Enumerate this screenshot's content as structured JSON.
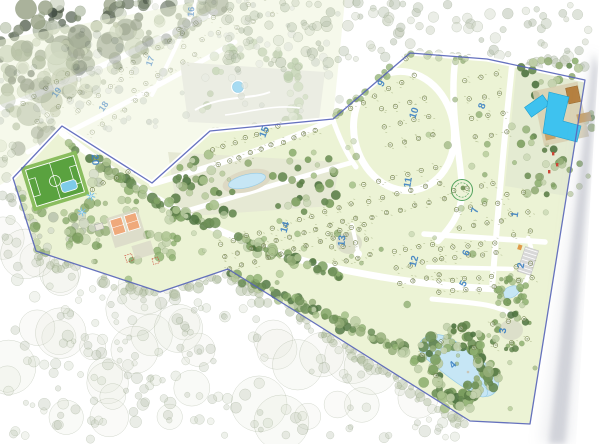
{
  "map": {
    "title_hidden": "",
    "colors": {
      "land": "#ecf3d5",
      "faded_land": "#eef4d8",
      "road": "#ffffff",
      "boundary": "#5563b8",
      "zone_label": "#3a7ec2",
      "marker": "#66753b",
      "marker_text": "#44541f",
      "water": "#c6e6f5",
      "water_edge": "#97cbe4",
      "pool": "#3ec2ef",
      "field_green": "#5aa23f",
      "field_band": "#8abd5e",
      "court_orange": "#efa97b",
      "clearing": "#dcdfca",
      "resort_ground": "#e4ebd2",
      "deck_tan": "#d8cfb0",
      "building_brown": "#b5803f",
      "building_tan": "#c9a268",
      "accent_red": "#cc4737",
      "palm_blue": "#7fc3e8",
      "roundabout_green": "#52a25c",
      "page_shadow": "#aab0ba"
    },
    "boundary_points": [
      [
        13,
        178
      ],
      [
        62,
        126
      ],
      [
        152,
        183
      ],
      [
        210,
        131
      ],
      [
        333,
        119
      ],
      [
        410,
        53
      ],
      [
        487,
        59
      ],
      [
        585,
        80
      ],
      [
        530,
        424
      ],
      [
        470,
        421
      ],
      [
        300,
        314
      ],
      [
        228,
        269
      ],
      [
        160,
        292
      ],
      [
        36,
        251
      ]
    ],
    "faded_land_points": [
      [
        0,
        40
      ],
      [
        205,
        0
      ],
      [
        345,
        0
      ],
      [
        333,
        119
      ],
      [
        210,
        131
      ],
      [
        152,
        183
      ],
      [
        62,
        126
      ],
      [
        13,
        178
      ],
      [
        0,
        185
      ]
    ],
    "park_faded": {
      "clearing": [
        [
          180,
          62
        ],
        [
          325,
          72
        ],
        [
          318,
          128
        ],
        [
          188,
          122
        ]
      ],
      "pool": {
        "cx": 238,
        "cy": 87,
        "r": 5.5
      }
    },
    "park_strip": [
      [
        168,
        152
      ],
      [
        340,
        162
      ],
      [
        332,
        206
      ],
      [
        178,
        217
      ]
    ],
    "zones": [
      {
        "number": "1",
        "label": {
          "x": 518,
          "y": 215,
          "rot": -80
        },
        "faded": false,
        "plots": {
          "cx": 519,
          "cy": 213,
          "w": 34,
          "h": 62,
          "rot": -10,
          "rows": 3,
          "cols": 2
        }
      },
      {
        "number": "2",
        "label": {
          "x": 524,
          "y": 266,
          "rot": -80
        },
        "faded": false,
        "plots": {
          "cx": 524,
          "cy": 272,
          "w": 28,
          "h": 30,
          "rot": -10,
          "rows": 2,
          "cols": 2
        }
      },
      {
        "number": "3",
        "label": {
          "x": 506,
          "y": 331,
          "rot": -85
        },
        "faded": false,
        "plots": {
          "cx": 510,
          "cy": 332,
          "w": 48,
          "h": 40,
          "rot": -10,
          "rows": 2,
          "cols": 3
        }
      },
      {
        "number": "4",
        "label": {
          "x": 455,
          "y": 367,
          "rot": -45
        },
        "faded": false,
        "plots": {
          "cx": 448,
          "cy": 352,
          "w": 70,
          "h": 50,
          "rot": -35,
          "rows": 2,
          "cols": 3
        }
      },
      {
        "number": "5",
        "label": {
          "x": 466,
          "y": 285,
          "rot": -62
        },
        "faded": false,
        "plots": {
          "cx": 466,
          "cy": 284,
          "w": 68,
          "h": 22,
          "rot": -5,
          "rows": 2,
          "cols": 5
        }
      },
      {
        "number": "6",
        "label": {
          "x": 469,
          "y": 254,
          "rot": -68
        },
        "faded": false,
        "plots": {
          "cx": 468,
          "cy": 251,
          "w": 68,
          "h": 20,
          "rot": -6,
          "rows": 2,
          "cols": 5
        }
      },
      {
        "number": "7",
        "label": {
          "x": 478,
          "y": 211,
          "rot": -78
        },
        "faded": false,
        "plots": {
          "cx": 477,
          "cy": 206,
          "w": 55,
          "h": 56,
          "rot": -10,
          "rows": 3,
          "cols": 4
        }
      },
      {
        "number": "8",
        "label": {
          "x": 485,
          "y": 107,
          "rot": -70
        },
        "faded": false,
        "plots": {
          "cx": 486,
          "cy": 106,
          "w": 48,
          "h": 78,
          "rot": -10,
          "rows": 4,
          "cols": 3
        }
      },
      {
        "number": "9",
        "label": {
          "x": 384,
          "y": 85,
          "rot": -60
        },
        "faded": false,
        "plots": {
          "cx": 378,
          "cy": 84,
          "w": 85,
          "h": 36,
          "rot": -28,
          "rows": 2,
          "cols": 6
        }
      },
      {
        "number": "10",
        "label": {
          "x": 417,
          "y": 114,
          "rot": -72
        },
        "faded": false,
        "plots": {
          "cx": 407,
          "cy": 122,
          "w": 60,
          "h": 56,
          "rot": -14,
          "rows": 3,
          "cols": 4
        }
      },
      {
        "number": "11",
        "label": {
          "x": 411,
          "y": 183,
          "rot": -80
        },
        "faded": false,
        "plots": {
          "cx": 404,
          "cy": 192,
          "w": 88,
          "h": 50,
          "rot": -14,
          "rows": 3,
          "cols": 6
        }
      },
      {
        "number": "12",
        "label": {
          "x": 417,
          "y": 262,
          "rot": -75
        },
        "faded": false,
        "plots": {
          "cx": 416,
          "cy": 264,
          "w": 52,
          "h": 48,
          "rot": -12,
          "rows": 3,
          "cols": 4
        }
      },
      {
        "number": "13",
        "label": {
          "x": 345,
          "y": 241,
          "rot": -85
        },
        "faded": false,
        "plots": {
          "cx": 349,
          "cy": 244,
          "w": 48,
          "h": 46,
          "rot": -12,
          "rows": 3,
          "cols": 4
        }
      },
      {
        "number": "14",
        "label": {
          "x": 288,
          "y": 228,
          "rot": -75
        },
        "faded": false,
        "plots": {
          "cx": 290,
          "cy": 237,
          "w": 150,
          "h": 40,
          "rot": -17,
          "rows": 3,
          "cols": 11
        }
      },
      {
        "number": "15",
        "label": {
          "x": 267,
          "y": 133,
          "rot": -70
        },
        "faded": false,
        "plots": {
          "cx": 264,
          "cy": 140,
          "w": 115,
          "h": 32,
          "rot": -20,
          "rows": 2,
          "cols": 10
        }
      },
      {
        "number": "16",
        "label": {
          "x": 194,
          "y": 12,
          "rot": -85
        },
        "faded": true,
        "plots": {
          "cx": 225,
          "cy": 22,
          "w": 110,
          "h": 36,
          "rot": -20,
          "rows": 2,
          "cols": 6
        }
      },
      {
        "number": "17",
        "label": {
          "x": 153,
          "y": 62,
          "rot": -70
        },
        "faded": true,
        "plots": {
          "cx": 158,
          "cy": 62,
          "w": 85,
          "h": 48,
          "rot": -30,
          "rows": 2,
          "cols": 6
        }
      },
      {
        "number": "18",
        "label": {
          "x": 106,
          "y": 108,
          "rot": -55
        },
        "faded": true,
        "plots": {
          "cx": 112,
          "cy": 102,
          "w": 80,
          "h": 52,
          "rot": -35,
          "rows": 2,
          "cols": 6
        }
      },
      {
        "number": "19",
        "label": {
          "x": 59,
          "y": 94,
          "rot": -55
        },
        "faded": true,
        "plots": {
          "cx": 52,
          "cy": 98,
          "w": 66,
          "h": 44,
          "rot": -35,
          "rows": 2,
          "cols": 5
        }
      },
      {
        "number": "20",
        "label": {
          "x": 92,
          "y": 160,
          "rot": 85
        },
        "faded": false,
        "plots": {
          "cx": 128,
          "cy": 172,
          "w": 92,
          "h": 20,
          "rot": -25,
          "rows": 1,
          "cols": 7
        }
      }
    ],
    "plot_numbering": "sequential",
    "roads": [
      {
        "d": "M13,178 L62,126 L152,183 L210,131 L333,119 L410,53 L487,59 L585,80",
        "w": 5
      },
      {
        "d": "M62,133 C140,195 220,240 320,265 C380,278 430,286 497,289",
        "w": 7
      },
      {
        "d": "M152,184 C200,170 260,152 333,120",
        "w": 6
      },
      {
        "d": "M170,216 C230,198 290,180 350,163",
        "w": 5
      },
      {
        "d": "M333,120 C340,140 348,156 356,167",
        "w": 5
      },
      {
        "d": "M455,62 C449,110 462,165 462,190 C462,215 448,230 438,241",
        "w": 6.5
      },
      {
        "d": "M512,66 C504,140 498,210 492,289",
        "w": 6
      },
      {
        "d": "M424,234 L545,242",
        "w": 5.5
      },
      {
        "d": "M428,267 L512,269",
        "w": 4.5
      },
      {
        "d": "M432,299 C470,303 500,303 516,318",
        "w": 5
      },
      {
        "d": "M528,238 C536,258 532,278 516,294",
        "w": 4.5
      },
      {
        "d": "M352,225 L358,252",
        "w": 4
      }
    ],
    "ring_road": {
      "cx": 404,
      "cy": 131,
      "rx": 50,
      "ry": 60,
      "rot": -12,
      "w": 7
    },
    "faded_roads": [
      {
        "d": "M0,108 C60,88 140,48 215,12",
        "w": 6
      },
      {
        "d": "M28,152 C90,122 160,86 235,42",
        "w": 5
      },
      {
        "d": "M196,2 C180,40 165,70 152,95",
        "w": 4
      }
    ],
    "water": [
      {
        "name": "central-pond",
        "type": "pond",
        "cx": 247,
        "cy": 181,
        "rx": 19,
        "ry": 6.5,
        "rot": -14,
        "beach": true
      },
      {
        "name": "south-pond",
        "type": "pond",
        "cx": 511,
        "cy": 292,
        "rx": 9,
        "ry": 5.5,
        "rot": -25,
        "beach": false
      },
      {
        "name": "lake",
        "type": "lake",
        "d": "M421,341 C430,330 448,334 460,345 C472,355 488,362 496,375 C503,386 494,399 482,396 C470,393 452,380 440,370 C428,360 414,352 421,341 Z",
        "lobe": {
          "cx": 479,
          "cy": 389,
          "rx": 10,
          "ry": 6,
          "rot": 40
        }
      },
      {
        "name": "park-pool",
        "type": "pool-circle",
        "cx": 238,
        "cy": 87,
        "r": 5.5
      },
      {
        "name": "resort-lap-pool",
        "type": "pool-rect",
        "cx": 537,
        "cy": 106,
        "w": 22,
        "h": 12,
        "rot": -35
      },
      {
        "name": "resort-main-pool",
        "type": "pool-path",
        "d": "M549,92 L569,97 L563,121 L581,126 L577,142 L543,133 Z"
      }
    ],
    "features": {
      "soccer_field": {
        "cx": 55,
        "cy": 181,
        "rot": -17
      },
      "tennis_courts": {
        "cx": 126,
        "cy": 229,
        "rot": -17
      },
      "playground": {
        "cx": 143,
        "cy": 250,
        "rot": -17
      },
      "small_pool": {
        "cx": 69,
        "cy": 186,
        "rot": -17
      },
      "palms": [
        [
          91,
          196
        ],
        [
          82,
          212
        ]
      ],
      "roundabout": {
        "cx": 462,
        "cy": 190,
        "r": 10.5
      },
      "parking": {
        "cx": 528,
        "cy": 261,
        "rot": -72
      },
      "resort_poly": [
        [
          517,
          64
        ],
        [
          585,
          82
        ],
        [
          567,
          196
        ],
        [
          505,
          186
        ]
      ],
      "clearing_13": {
        "cx": 349,
        "cy": 243,
        "rx": 13,
        "ry": 11
      },
      "clearing_3": {
        "cx": 511,
        "cy": 330,
        "rx": 12,
        "ry": 10
      }
    },
    "page_edge": {
      "top": [
        594,
        52
      ],
      "bottom": [
        554,
        444
      ]
    }
  }
}
